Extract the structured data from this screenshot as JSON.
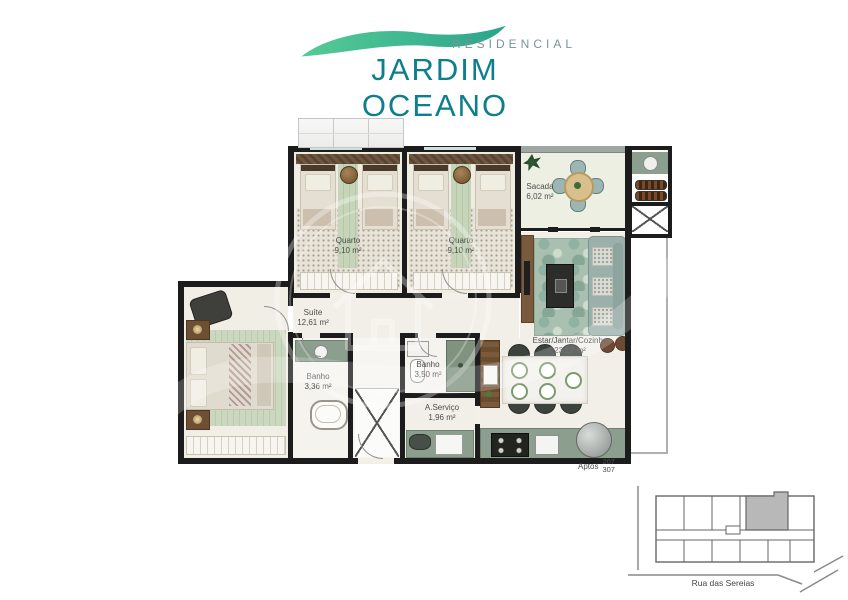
{
  "logo": {
    "brand_top": "RESIDENCIAL",
    "brand_name": "JARDIM OCEANO"
  },
  "rooms": {
    "quarto1": {
      "name": "Quarto",
      "area": "9,10 m²"
    },
    "quarto2": {
      "name": "Quarto",
      "area": "9,10 m²"
    },
    "sacada": {
      "name": "Sacada",
      "area": "6,02 m²"
    },
    "suite": {
      "name": "Suíte",
      "area": "12,61 m²"
    },
    "banho_suite": {
      "name": "Banho",
      "area": "3,36 m²"
    },
    "banho_social": {
      "name": "Banho",
      "area": "3,50 m²"
    },
    "servico": {
      "name": "A.Serviço",
      "area": "1,96 m²"
    },
    "estar": {
      "name": "Estar/Jantar/Cozinha",
      "area": "23,17 m²"
    }
  },
  "apartments": {
    "label": "Aptos",
    "units": [
      "207",
      "307"
    ]
  },
  "site_map": {
    "street": "Rua das Sereias"
  },
  "colors": {
    "brand_teal": "#0d7f8c",
    "wave_green": "#45c08d",
    "wall": "#1c1c1c"
  }
}
